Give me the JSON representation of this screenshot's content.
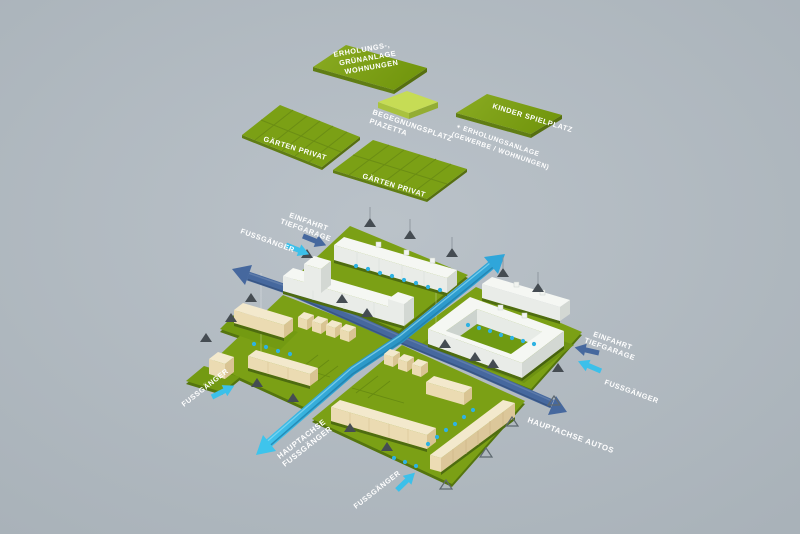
{
  "background_color": "#b3bbc2",
  "colors": {
    "area_green": "#7ba015",
    "area_green_dark": "#5a7712",
    "piazetta_green": "#c6dc55",
    "building_white": "#f5f7f3",
    "building_cream": "#f3e9cd",
    "axis_autos_blue": "#46689e",
    "axis_pedestrian_cyan": "#35b0e0",
    "path_dot_blue": "#2eb2e2",
    "tree_marker_gray": "#454c52",
    "label_white": "#ffffff"
  },
  "areas": {
    "erholungs_gruenanlage": {
      "label_lines": [
        "ERHOLUNGS-,",
        "GRÜNANLAGE",
        "WOHNUNGEN"
      ]
    },
    "begegnungsplatz_piazetta": {
      "label_lines": [
        "BEGEGNUNGSPLATZ",
        "PIAZETTA"
      ]
    },
    "kinder_spielplatz": {
      "label": "KINDER SPIELPLATZ",
      "sub_lines": [
        "+ ERHOLUNGSANLAGE",
        "(GEWERBE / WOHNUNGEN)"
      ]
    },
    "gaerten_privat_left": {
      "label": "GÄRTEN PRIVAT"
    },
    "gaerten_privat_center": {
      "label": "GÄRTEN PRIVAT"
    }
  },
  "site": {
    "axes": {
      "hauptachse_fussgaenger_lines": [
        "HAUPTACHSE",
        "FUSSGÄNGER"
      ],
      "hauptachse_autos": "HAUPTACHSE AUTOS"
    },
    "entrances": {
      "fussgaenger": "FUSSGÄNGER",
      "einfahrt_tiefgarage_lines": [
        "EINFAHRT",
        "TIEFGARAGE"
      ]
    }
  }
}
